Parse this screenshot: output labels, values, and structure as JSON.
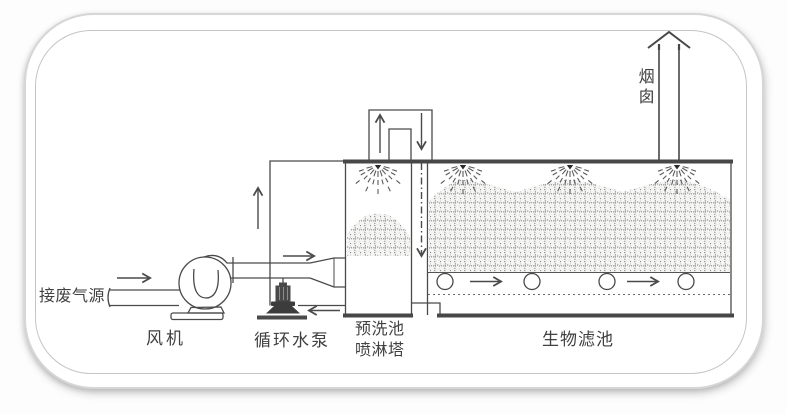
{
  "diagram": {
    "type": "process-flow-schematic",
    "subject": "biological filter waste-gas treatment system",
    "labels": {
      "waste_gas_source": "接废气源",
      "fan": "风机",
      "circulating_pump": "循环水泵",
      "prewash_pool": "预洗池",
      "spray_tower": "喷淋塔",
      "biofilter": "生物滤池",
      "chimney": "烟囱"
    },
    "elements": [
      "gas inlet pipe with right flow arrow",
      "centrifugal fan with base pedestal",
      "vertical circulating pump with ground base",
      "water circulation loop with up arrow and left return arrow",
      "diffuser cone into spray tower",
      "spray tower with one nozzle and packing mound",
      "inverted-U crossover duct with up and down arrows",
      "dash-dot gas downcomer line with down arrow",
      "biofilter tank with three spray nozzles and packing media",
      "four drain-pipe circles with two right flow arrows",
      "dotted false floor line",
      "chimney with open up arrowhead"
    ],
    "counts": {
      "biofilter_spray_nozzles": 3,
      "tower_spray_nozzles": 1,
      "drain_pipe_circles": 4
    },
    "colors": {
      "background": "#ffffff",
      "frame_border": "#d6d6d6",
      "line": "#4a4a4a",
      "text": "#414141",
      "media_fill": "#f5f5f4",
      "media_ring": "#787878"
    }
  }
}
